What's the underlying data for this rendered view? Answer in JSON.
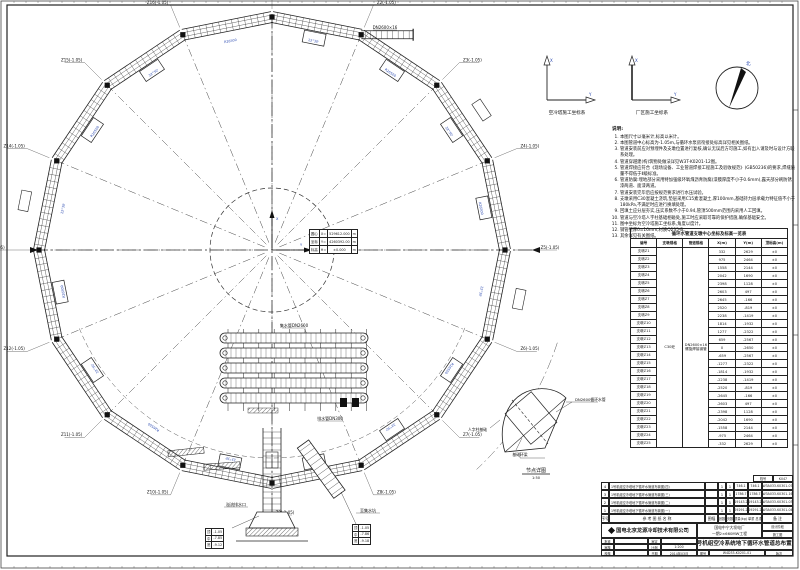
{
  "compass": {
    "axis1_caption": "空冷塔施工坐标系",
    "axis2_caption": "厂区施工坐标系",
    "axis_x_label": "X",
    "axis_y_label": "Y",
    "north_label": "北"
  },
  "notes": {
    "title": "说明:",
    "lines": [
      "1. 本图尺寸以毫米计,标高以米计。",
      "2. 本图管道中心标高为-1.05m,与循环水泵房衔接处标高详见相关图纸。",
      "3. 管道安装前应对预埋件及支墩位置进行复核,确认无误后方可施工,如有出入请及时与设计方联系处理。",
      "4. 管道穿越建(构)筑物处做法详见W3T-K0201-12图。",
      "5. 管道焊接应符合《现场设备、工业管道焊接工程施工及验收规范》(GB50236)的要求,焊缝质量不得低于Ⅱ级标准。",
      "6. 管道防腐:埋地部分采用特加强级环氧煤沥青防腐(漆膜厚度不小于0.6mm),露天部分刷防锈漆两道、面漆两道。",
      "7. 管道安装完毕后应按规范要求进行水压试验。",
      "8. 支墩采用C30混凝土浇筑,垫层采用C15素混凝土,厚100mm,基础持力层承载力特征值不小于180kPa,不满足时应进行换填处理。",
      "9. 回填土应分层夯实,压实系数不小于0.94,管顶500mm范围内采用人工回填。",
      "10. 管道与空冷塔人字柱基础相碰处,施工时应采取可靠的保护措施,确保基础安全。",
      "11. 图中坐标为空冷塔施工坐标系,角度以度计。",
      "12. 钢管壁厚δ=16mm,材质Q235-B。",
      "13. 其余详见有关图纸。"
    ]
  },
  "coord_table": {
    "title": "循环水管道支墩中心坐标及标高一览表",
    "headers": [
      "编号",
      "支墩规格",
      "管道规格",
      "X(m)",
      "Y(m)",
      "顶标高(m)"
    ],
    "merged_col2": "C30砼",
    "merged_col3": "DN2600×16 螺旋焊接钢管",
    "z_value": "±0",
    "rows": [
      [
        "支墩Z1",
        "332",
        "2629",
        "±0"
      ],
      [
        "支墩Z2",
        "975",
        "2464",
        "±0"
      ],
      [
        "支墩Z3",
        "1558",
        "2144",
        "±0"
      ],
      [
        "支墩Z4",
        "2042",
        "1690",
        "±0"
      ],
      [
        "支墩Z5",
        "2398",
        "1128",
        "±0"
      ],
      [
        "支墩Z6",
        "2603",
        "497",
        "±0"
      ],
      [
        "支墩Z7",
        "2645",
        "-166",
        "±0"
      ],
      [
        "支墩Z8",
        "2520",
        "-819",
        "±0"
      ],
      [
        "支墩Z9",
        "2238",
        "-1419",
        "±0"
      ],
      [
        "支墩Z10",
        "1814",
        "-1932",
        "±0"
      ],
      [
        "支墩Z11",
        "1277",
        "-2322",
        "±0"
      ],
      [
        "支墩Z12",
        "659",
        "-2567",
        "±0"
      ],
      [
        "支墩Z13",
        "0",
        "-2650",
        "±0"
      ],
      [
        "支墩Z14",
        "-659",
        "-2567",
        "±0"
      ],
      [
        "支墩Z15",
        "-1277",
        "-2322",
        "±0"
      ],
      [
        "支墩Z16",
        "-1814",
        "-1932",
        "±0"
      ],
      [
        "支墩Z17",
        "-2238",
        "-1419",
        "±0"
      ],
      [
        "支墩Z18",
        "-2520",
        "-819",
        "±0"
      ],
      [
        "支墩Z19",
        "-2645",
        "-166",
        "±0"
      ],
      [
        "支墩Z20",
        "-2603",
        "497",
        "±0"
      ],
      [
        "支墩Z21",
        "-2398",
        "1128",
        "±0"
      ],
      [
        "支墩Z22",
        "-2042",
        "1690",
        "±0"
      ],
      [
        "支墩Z23",
        "-1558",
        "2144",
        "±0"
      ],
      [
        "支墩Z24",
        "-975",
        "2464",
        "±0"
      ],
      [
        "支墩Z25",
        "-332",
        "2629",
        "±0"
      ]
    ]
  },
  "center_table": {
    "rows": [
      [
        "圆心",
        "X=",
        "529612.000",
        "m"
      ],
      [
        "坐标",
        "Y=",
        "4260392.00",
        "m"
      ],
      [
        "标高",
        "H=",
        "±0.000",
        "m"
      ]
    ]
  },
  "ring": {
    "labels": [
      "Z1(-1.05)",
      "Z2(-1.05)",
      "Z3(-1.05)",
      "Z4(-1.05)",
      "Z5(-1.05)",
      "Z6(-1.05)",
      "Z7(-1.05)",
      "Z8(-1.05)",
      "Z9(-1.05)",
      "Z10(-1.05)",
      "Z11(-1.05)",
      "Z12(-1.05)",
      "Z13(-1.05)",
      "Z14(-1.05)",
      "Z15(-1.05)",
      "Z16(-1.05)"
    ],
    "dim_a": "R26500",
    "dim_b": "22°30'",
    "extra_labels": [
      {
        "t": "DN2600×16",
        "x": 385,
        "y": 29
      },
      {
        "t": "集水管DN2600",
        "x": 294,
        "y": 327
      },
      {
        "t": "排水管DN300",
        "x": 330,
        "y": 420
      },
      {
        "t": "溢流排水口",
        "x": 236,
        "y": 506
      },
      {
        "t": "至集水坑",
        "x": 368,
        "y": 512
      }
    ]
  },
  "bottom_left_table": {
    "rows": [
      [
        "顶",
        "-1.05"
      ],
      [
        "中",
        "-7.85"
      ],
      [
        "底",
        "-9.12"
      ]
    ]
  },
  "bottom_right_table": {
    "rows": [
      [
        "顶",
        "-1.05"
      ],
      [
        "中",
        "-7.86"
      ],
      [
        "底",
        "-9.18"
      ]
    ]
  },
  "detail": {
    "labels": [
      "人字柱基础",
      "基础环梁",
      "DN2600循环水管"
    ],
    "caption": "节点详图",
    "scale": "1:50"
  },
  "titleblock": {
    "archive_label": "档号",
    "archive_no": "K047",
    "refs": [
      {
        "no": "4",
        "name": "1号机组空冷塔地下循环水管道布置图(四)",
        "sheet": "1",
        "page": "1",
        "w1": "746.1",
        "w2": "746.1",
        "fig": "W3A033-K0301-07"
      },
      {
        "no": "3",
        "name": "1号机组空冷塔地下循环水管道布置图(三)",
        "sheet": "1",
        "page": "1",
        "w1": "1786.7",
        "w2": "1786.7",
        "fig": "W3A033-K0301-16"
      },
      {
        "no": "2",
        "name": "1号机组空冷塔地下循环水管道布置图(二)",
        "sheet": "1",
        "page": "1",
        "w1": "19143.2",
        "w2": "19143.2",
        "fig": "W3A033-K0301-03"
      },
      {
        "no": "1",
        "name": "1号机组空冷塔地下循环水管道布置图(一)",
        "sheet": "1",
        "page": "1",
        "w1": "29291.2",
        "w2": "29291.2",
        "fig": "W3A033-K0301-04"
      }
    ],
    "ref_headers": {
      "no": "序号",
      "name": "参 考 图 纸 名 称",
      "size": "图幅",
      "sheet": "张数",
      "page": "页数",
      "weight": "质量(kg) 单重 总重",
      "remark": "备 注"
    },
    "company": "国电北京龙源冷却技术有限公司",
    "project_line1": "国电中宁大坝电厂",
    "project_line2": "一期2×660MW工程",
    "stage_label": "设计阶段",
    "stage_value": "施工图",
    "sign_rows": [
      [
        "批准",
        "",
        "审定",
        ""
      ],
      [
        "审核",
        "",
        "比例",
        "1:200"
      ],
      [
        "校核",
        "",
        "日期",
        "2014年03月"
      ]
    ],
    "title": "1号机组空冷系统地下循环水管道总布置图",
    "figno_label": "图号",
    "figno": "W4D33-K0201-01",
    "rev_label": "版次"
  },
  "colors": {
    "line": "#222222",
    "blue": "#2a49b0",
    "paper": "#ffffff"
  }
}
